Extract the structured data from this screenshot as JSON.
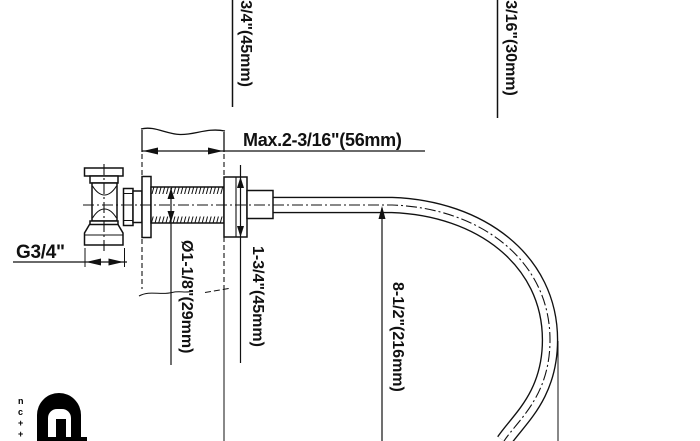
{
  "dimensions": {
    "top_left_vertical": "1-3/4\"(45mm)",
    "top_right_vertical": "1-3/16\"(30mm)",
    "wall_max_thickness": "Max.2-3/16\"(56mm)",
    "thread_size": "G3/4\"",
    "body_diameter": "Ø1-1/8\"(29mm)",
    "escutcheon_height": "1-3/4\"(45mm)",
    "spout_drop": "8-1/2\"(216mm)"
  },
  "logo": {
    "vertical_letters": [
      "n",
      "c",
      "+",
      "+"
    ]
  },
  "colors": {
    "line": "#111111",
    "background": "#ffffff"
  }
}
